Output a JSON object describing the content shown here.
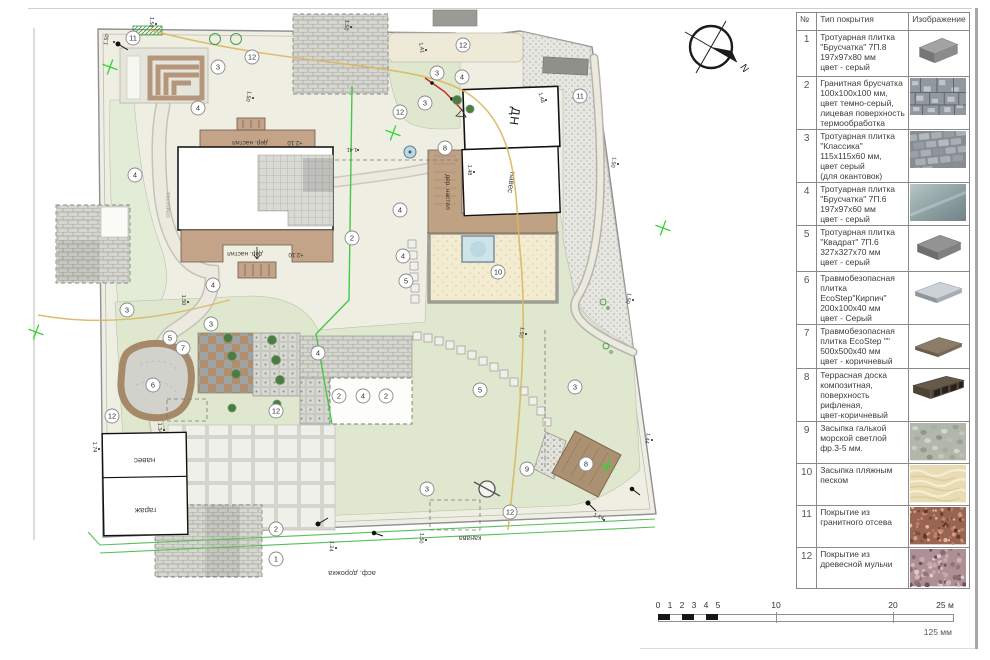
{
  "legend": {
    "headers": {
      "num": "№",
      "type": "Тип покрытия",
      "image": "Изображение"
    },
    "rows": [
      {
        "num": "1",
        "text": "Тротуарная плитка\n\"Брусчатка\" 7П.8\n197х97х80 мм\nцвет - серый",
        "swatch": "brick3d",
        "h": 46
      },
      {
        "num": "2",
        "text": "Гранитная брусчатка\n100х100х100 мм,\nцвет темно-серый,\nлицевая поверхность\nтермообработка",
        "swatch": "granite",
        "h": 52
      },
      {
        "num": "3",
        "text": "Тротуарная плитка\n\"Классика\"\n115х115х60 мм,\nцвет серый\n(для окантовок)",
        "swatch": "pavers",
        "h": 50
      },
      {
        "num": "4",
        "text": "Тротуарная плитка\n\"Брусчатка\" 7П.6\n197х97х60 мм\nцвет - серый",
        "swatch": "tile",
        "h": 42
      },
      {
        "num": "5",
        "text": "Тротуарная плитка\n\"Квадрат\" 7П.6\n327х327х70 мм\nцвет - серый",
        "swatch": "slab3d",
        "h": 46
      },
      {
        "num": "6",
        "text": "Травмобезопасная\nплитка EcoStep\"Кирпич\"\n200х100х40 мм\nцвет - Серый",
        "swatch": "ecostep_grey",
        "h": 46
      },
      {
        "num": "7",
        "text": "Травмобезопасная\nплитка EcoStep \"\"\n500х500х40 мм\nцвет - коричневый",
        "swatch": "ecostep_brown",
        "h": 44
      },
      {
        "num": "8",
        "text": "Террасная доска\nкомпозитная,\nповерхность рифленая,\nцвет-коричневый",
        "swatch": "deck",
        "h": 40
      },
      {
        "num": "9",
        "text": "Засыпка галькой\nморской светлой\nфр.3-5 мм.",
        "swatch": "pebbles",
        "h": 42
      },
      {
        "num": "10",
        "text": "Засыпка пляжным\nпеском",
        "swatch": "sand",
        "h": 42
      },
      {
        "num": "11",
        "text": "Покрытие из\nгранитного отсева",
        "swatch": "granite_chips",
        "h": 42
      },
      {
        "num": "12",
        "text": "Покрытие из\nдревесной мульчи",
        "swatch": "mulch",
        "h": 33
      }
    ]
  },
  "scalebar": {
    "ticks": [
      "0",
      "1",
      "2",
      "3",
      "4",
      "5",
      "10",
      "20",
      "25 м"
    ],
    "caption": "125 мм"
  },
  "compass": {
    "label": "N"
  },
  "plan": {
    "labels": {
      "dn": "ДН",
      "naves_dn": "навес",
      "naves_garage": "навес",
      "garage": "гараж",
      "deck_top": "дер. настил",
      "deck_bottom": "дер. настил",
      "deck_side": "дер. настил",
      "level_top": "+2.10",
      "level_bottom": "+2.10",
      "otmostka": "отмостка",
      "ditch": "канава",
      "road": "асф. дорожка"
    },
    "markers": [
      {
        "x": 133,
        "y": 38,
        "n": "11"
      },
      {
        "x": 252,
        "y": 57,
        "n": "12"
      },
      {
        "x": 218,
        "y": 67,
        "n": "3"
      },
      {
        "x": 198,
        "y": 108,
        "n": "4"
      },
      {
        "x": 463,
        "y": 45,
        "n": "12"
      },
      {
        "x": 437,
        "y": 73,
        "n": "3"
      },
      {
        "x": 425,
        "y": 103,
        "n": "3"
      },
      {
        "x": 462,
        "y": 77,
        "n": "4"
      },
      {
        "x": 400,
        "y": 112,
        "n": "12"
      },
      {
        "x": 580,
        "y": 96,
        "n": "11"
      },
      {
        "x": 445,
        "y": 148,
        "n": "8"
      },
      {
        "x": 352,
        "y": 238,
        "n": "2"
      },
      {
        "x": 213,
        "y": 285,
        "n": "4"
      },
      {
        "x": 403,
        "y": 256,
        "n": "4"
      },
      {
        "x": 406,
        "y": 281,
        "n": "5"
      },
      {
        "x": 400,
        "y": 210,
        "n": "4"
      },
      {
        "x": 127,
        "y": 310,
        "n": "3"
      },
      {
        "x": 211,
        "y": 324,
        "n": "3"
      },
      {
        "x": 170,
        "y": 338,
        "n": "5"
      },
      {
        "x": 183,
        "y": 348,
        "n": "7"
      },
      {
        "x": 153,
        "y": 385,
        "n": "6"
      },
      {
        "x": 112,
        "y": 416,
        "n": "12"
      },
      {
        "x": 276,
        "y": 411,
        "n": "12"
      },
      {
        "x": 318,
        "y": 353,
        "n": "4"
      },
      {
        "x": 339,
        "y": 396,
        "n": "2"
      },
      {
        "x": 363,
        "y": 396,
        "n": "4"
      },
      {
        "x": 386,
        "y": 396,
        "n": "2"
      },
      {
        "x": 480,
        "y": 390,
        "n": "5"
      },
      {
        "x": 427,
        "y": 489,
        "n": "3"
      },
      {
        "x": 527,
        "y": 469,
        "n": "9"
      },
      {
        "x": 575,
        "y": 387,
        "n": "3"
      },
      {
        "x": 586,
        "y": 464,
        "n": "8"
      },
      {
        "x": 510,
        "y": 512,
        "n": "12"
      },
      {
        "x": 276,
        "y": 529,
        "n": "2"
      },
      {
        "x": 276,
        "y": 559,
        "n": "1"
      },
      {
        "x": 498,
        "y": 272,
        "n": "10"
      },
      {
        "x": 135,
        "y": 175,
        "n": "4"
      }
    ],
    "plant_tags": [
      [
        215,
        39
      ],
      [
        236,
        39
      ]
    ],
    "crosses": [
      [
        110,
        67
      ],
      [
        36,
        332
      ],
      [
        393,
        133
      ],
      [
        607,
        466
      ],
      [
        663,
        228
      ]
    ],
    "dims": [
      {
        "x": 108,
        "y": 40,
        "a": -80,
        "t": "1.50"
      },
      {
        "x": 150,
        "y": 22,
        "a": 95,
        "t": "1.50"
      },
      {
        "x": 247,
        "y": 96,
        "a": 100,
        "t": "1.50"
      },
      {
        "x": 345,
        "y": 25,
        "a": 95,
        "t": "1.50"
      },
      {
        "x": 420,
        "y": 48,
        "a": 80,
        "t": "1.41"
      },
      {
        "x": 540,
        "y": 98,
        "a": 75,
        "t": "1.48"
      },
      {
        "x": 612,
        "y": 162,
        "a": 100,
        "t": "1.50"
      },
      {
        "x": 627,
        "y": 298,
        "a": 100,
        "t": "1.50"
      },
      {
        "x": 646,
        "y": 438,
        "a": 100,
        "t": "1.44"
      },
      {
        "x": 598,
        "y": 518,
        "a": 25,
        "t": "1.14"
      },
      {
        "x": 420,
        "y": 538,
        "a": 95,
        "t": "1.50"
      },
      {
        "x": 330,
        "y": 546,
        "a": 95,
        "t": "1.14"
      },
      {
        "x": 182,
        "y": 300,
        "a": 90,
        "t": "1.50"
      },
      {
        "x": 158,
        "y": 428,
        "a": 90,
        "t": "1.34"
      },
      {
        "x": 93,
        "y": 447,
        "a": 90,
        "t": "1.74"
      },
      {
        "x": 352,
        "y": 148,
        "a": 180,
        "t": "1.41"
      },
      {
        "x": 468,
        "y": 170,
        "a": 90,
        "t": "1.48"
      },
      {
        "x": 520,
        "y": 332,
        "a": 100,
        "t": "1.50"
      }
    ]
  },
  "colors": {
    "boundary": "#8f8f8f",
    "lawn": "#dfe8cf",
    "sand": "#f3ecd0",
    "terrace": "#c3a488",
    "mulch": "#efe9d8",
    "utility_yellow": "#d8b85e",
    "utility_green": "#45c845",
    "utility_red": "#cc2222",
    "cross_green": "#35d435"
  }
}
